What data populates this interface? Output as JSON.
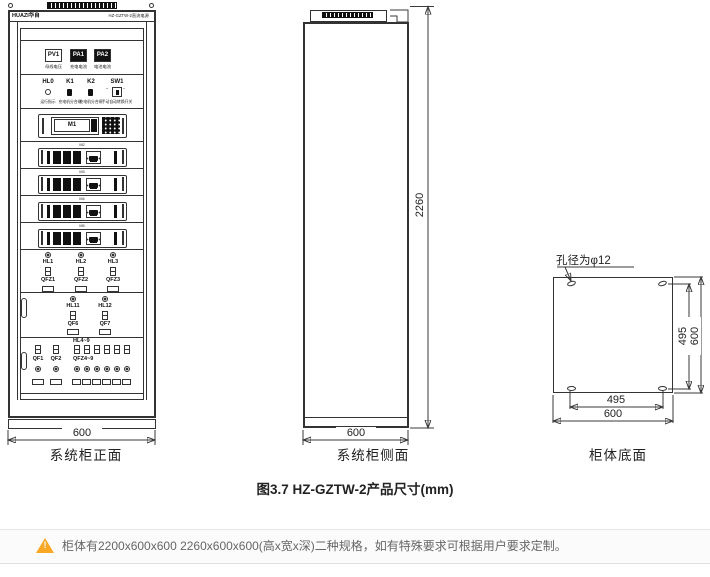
{
  "front": {
    "brand": "HUAZI华自",
    "model_header": "HZ-GZTW-2直流电源",
    "meters": [
      {
        "id": "PV1",
        "caption": "母线电压"
      },
      {
        "id": "PA1",
        "caption": "充电电流"
      },
      {
        "id": "PA2",
        "caption": "电池电流"
      }
    ],
    "controls": [
      {
        "id": "HL0",
        "caption": "运行指示"
      },
      {
        "id": "K1",
        "caption": "充电机分合闸"
      },
      {
        "id": "K2",
        "caption": "充电机分合闸"
      },
      {
        "id": "SW1",
        "caption": "手动自动转换开关"
      }
    ],
    "main_module": "M1",
    "modules": [
      "M2",
      "M3",
      "M4",
      "M5"
    ],
    "indicator_group1": [
      {
        "lamp": "HL1",
        "breaker": "QFZ1"
      },
      {
        "lamp": "HL2",
        "breaker": "QFZ2"
      },
      {
        "lamp": "HL3",
        "breaker": "QFZ3"
      }
    ],
    "indicator_group2": [
      {
        "lamp": "HL11",
        "breaker": "QF6"
      },
      {
        "lamp": "HL12",
        "breaker": "QF7"
      }
    ],
    "bottom_group": {
      "left_breakers": [
        "QF1",
        "QF2"
      ],
      "lamp_range": "HL4~9",
      "breaker_range": "QFZ4~9"
    },
    "width_dim": "600",
    "label": "系统柜正面"
  },
  "side": {
    "height_dim": "2260",
    "width_dim": "600",
    "label": "系统柜侧面"
  },
  "bottom_view": {
    "hole_note": "孔径为φ12",
    "dim_right_inner": "495",
    "dim_right_outer": "600",
    "dim_bottom_inner": "495",
    "dim_bottom_outer": "600",
    "label": "柜体底面"
  },
  "caption": "图3.7 HZ-GZTW-2产品尺寸(mm)",
  "note": {
    "text": "柜体有2200x600x600 2260x600x600(高x宽x深)二种规格，如有特殊要求可根据用户要求定制。",
    "icon_color": "#f9a825"
  }
}
